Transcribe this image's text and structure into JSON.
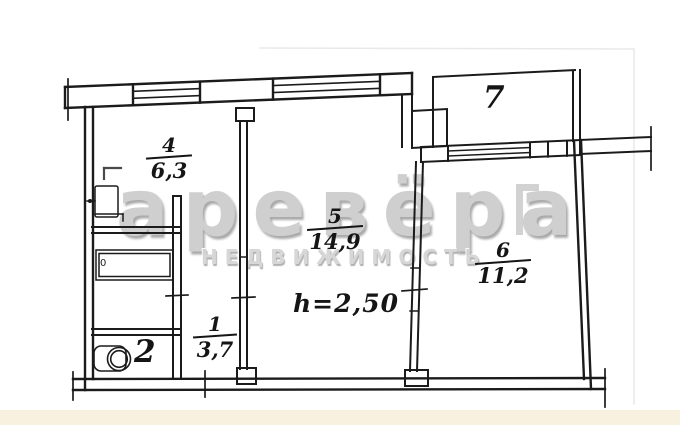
{
  "watermark": {
    "line1": "аревёра",
    "line2": "НЕДВИЖИМОСТЬ"
  },
  "plan": {
    "ceiling_height": "h=2,50",
    "bathtub_mark": "0",
    "rooms": {
      "hall": {
        "number": "1",
        "area": "3,7"
      },
      "wc": {
        "number": "2"
      },
      "kitchen": {
        "number": "4",
        "area": "6,3"
      },
      "living_room": {
        "number": "5",
        "area": "14,9"
      },
      "bedroom": {
        "number": "6",
        "area": "11,2"
      },
      "balcony": {
        "number": "7"
      }
    }
  },
  "colors": {
    "ink": "#1b1b1b",
    "watermark": "#c7c7c7",
    "paper": "#ffffff",
    "bottom_band": "#f8f1df"
  }
}
